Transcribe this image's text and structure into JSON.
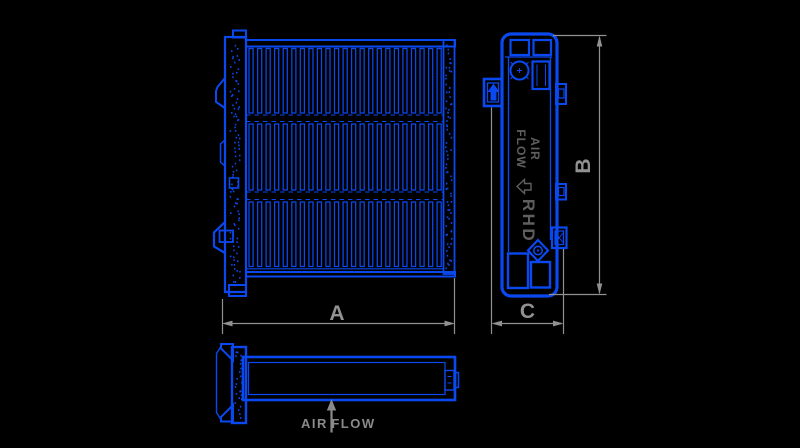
{
  "drawing": {
    "background": "#000000",
    "line_color": "#0a49f0",
    "dim_color": "#919191",
    "inner_text_color": "#5f5f5f",
    "flow_text_color": "#8a8a8a"
  },
  "dimensions": {
    "width_label": "A",
    "height_label": "B",
    "depth_label": "C"
  },
  "side_view": {
    "air_label": "AIR",
    "flow_label": "FLOW",
    "rhd_label": "RHD"
  },
  "bottom_view": {
    "air_label": "AIR",
    "flow_label": "FLOW"
  }
}
